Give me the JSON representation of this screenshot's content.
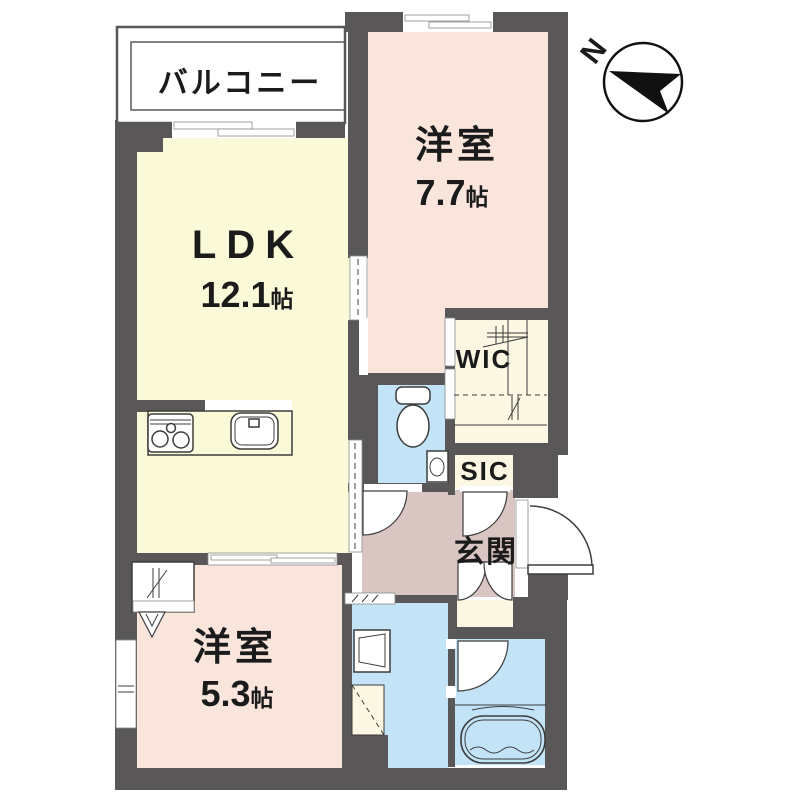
{
  "rooms": {
    "balcony": {
      "label": "バルコニー"
    },
    "bedroom1": {
      "label": "洋室",
      "size": "7.7",
      "unit": "帖"
    },
    "ldk": {
      "label": "LDK",
      "size": "12.1",
      "unit": "帖"
    },
    "bedroom2": {
      "label": "洋室",
      "size": "5.3",
      "unit": "帖"
    },
    "wic": {
      "label": "WIC"
    },
    "sic": {
      "label": "SIC"
    },
    "entrance": {
      "label": "玄関"
    }
  },
  "compass": {
    "label": "N"
  },
  "fixtures": [
    "stove",
    "kitchen-sink",
    "toilet",
    "hand-basin",
    "washing-machine",
    "bathtub"
  ],
  "colors": {
    "wall": "#595757",
    "ldk_floor": "#FAFAD9",
    "bedroom_floor": "#F9E5DC",
    "entrance_floor": "#D9C6C2",
    "wet_area_floor": "#C3E3F7",
    "storage_floor": "#FBF7E2"
  }
}
